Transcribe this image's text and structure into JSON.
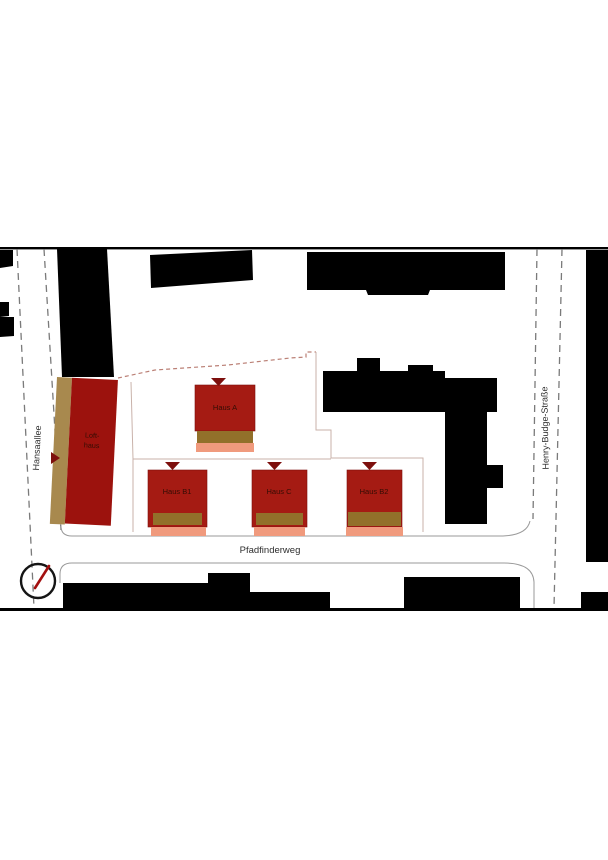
{
  "plan": {
    "title": "site-plan",
    "streets": {
      "hansaallee": {
        "label": "Hansaallee"
      },
      "henry_budge": {
        "label": "Henry-Budge-Straße"
      },
      "pfadfinderweg": {
        "label": "Pfadfinderweg"
      }
    },
    "buildings": {
      "loft": {
        "label_line1": "Loft-",
        "label_line2": "haus"
      },
      "haus_a": {
        "label": "Haus A"
      },
      "haus_b1": {
        "label": "Haus B1"
      },
      "haus_c": {
        "label": "Haus C"
      },
      "haus_b2": {
        "label": "Haus B2"
      }
    },
    "icons": {
      "compass": "north-arrow-circle",
      "entrance_marker": "triangle-marker"
    },
    "colors": {
      "building-red": "#a51b13",
      "loft-red": "#9c120d",
      "strip-brown": "#92702a",
      "loft-tan": "#a8894e",
      "strip-salmon": "#f09a7d",
      "existing-black": "#000000",
      "marker-red": "#7d0f0d",
      "boundary-red": "#bb8076",
      "boundary-light": "#c9b2aa",
      "street-dash": "#7a7a7a",
      "curb-gray": "#9a9a9a",
      "street-text": "#2e2e2e",
      "haus-text": "#330d04",
      "needle-red": "#a31010"
    }
  }
}
